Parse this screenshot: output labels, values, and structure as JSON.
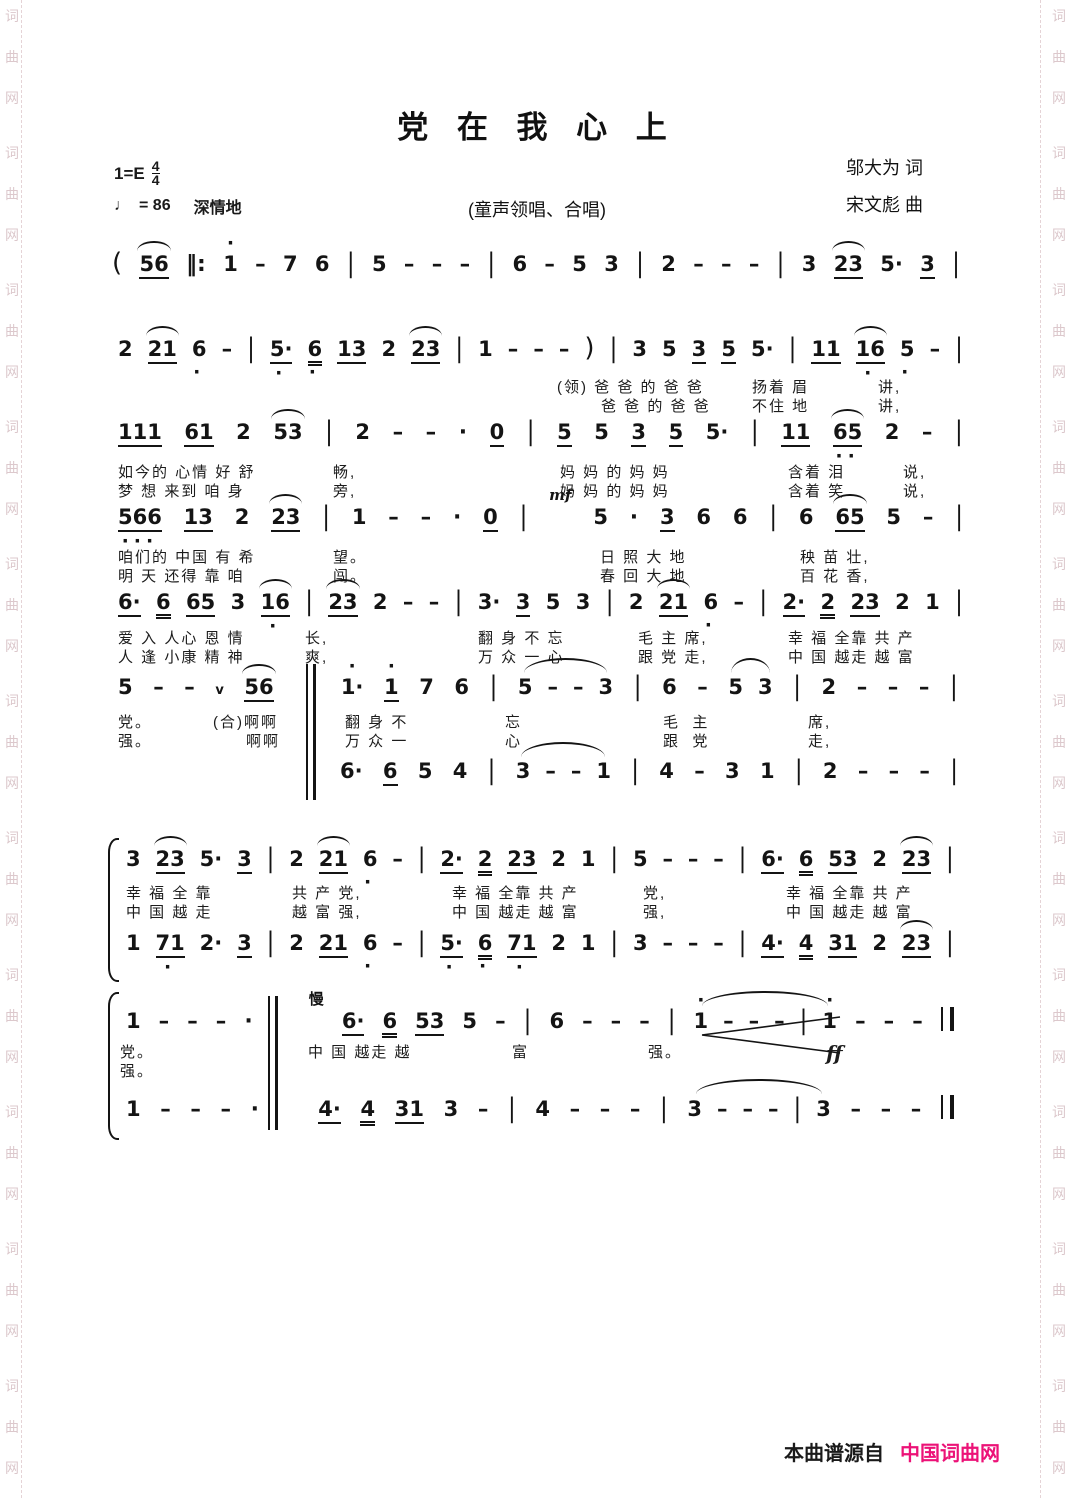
{
  "header": {
    "title": "党  在  我  心  上",
    "subtitle": "(童声领唱、合唱)",
    "lyricist": "邬大为  词",
    "composer": "宋文彪  曲",
    "key": "1=E",
    "meter_num": "4",
    "meter_den": "4",
    "tempo_note_icon": "♩",
    "tempo": "= 86",
    "expression": "深情地"
  },
  "watermark": {
    "chars": [
      "词",
      "曲",
      "网"
    ],
    "repeat": 11,
    "color": "#dcc8cc"
  },
  "footer": {
    "source_label": "本曲谱源自",
    "site_name": "中国词曲网",
    "site_color": "#ec1277"
  },
  "systems": [
    {
      "voices": [
        {
          "x": 112,
          "y": 248,
          "w": 848,
          "tokens": [
            "(",
            "56:u1,sl",
            "||:",
            "1:da",
            "-",
            "7",
            "6",
            "|",
            "5",
            "-",
            "-",
            "-",
            "|",
            "6",
            "-",
            "5",
            "3",
            "|",
            "2",
            "-",
            "-",
            "-",
            "|",
            "3",
            "23:u1,sl",
            "5·",
            "3:u1",
            "|"
          ]
        }
      ],
      "lyrics": []
    },
    {
      "voices": [
        {
          "x": 118,
          "y": 333,
          "w": 845,
          "tokens": [
            "2",
            "21:u1,sl",
            "6:db",
            "-",
            "|",
            "5·:u1,db",
            "6:u2,db",
            "13:u1",
            "2",
            "23:u1,sl",
            "|",
            "1",
            "-",
            "-",
            "-",
            ")",
            "|",
            "3",
            "5",
            "3:u1",
            "5:u1",
            "5·",
            "|",
            "11:u1",
            "16:u1,sl,db",
            "5:db",
            "-",
            "|"
          ]
        }
      ],
      "lyrics": [
        {
          "y": 376,
          "segs": [
            {
              "x": 557,
              "t": "(领) 爸 爸 的 爸 爸"
            },
            {
              "x": 752,
              "t": "扬着 眉"
            },
            {
              "x": 878,
              "t": "讲,"
            }
          ]
        },
        {
          "y": 395,
          "segs": [
            {
              "x": 601,
              "t": "爸 爸 的 爸 爸"
            },
            {
              "x": 752,
              "t": "不住 地"
            },
            {
              "x": 878,
              "t": "讲,"
            }
          ]
        }
      ]
    },
    {
      "voices": [
        {
          "x": 118,
          "y": 419,
          "w": 845,
          "tokens": [
            "111:u1",
            "61:u1",
            "2",
            "53:sl",
            "|",
            "2",
            "-",
            "-",
            "·",
            "0:u1",
            "|",
            "5:u1",
            "5",
            "3:u1",
            "5:u1",
            "5·",
            "|",
            "11:u1",
            "65:u1,sl,db2",
            "2",
            "-",
            "|"
          ]
        }
      ],
      "lyrics": [
        {
          "y": 461,
          "segs": [
            {
              "x": 118,
              "t": "如今的 心情 好 舒"
            },
            {
              "x": 333,
              "t": "畅,"
            },
            {
              "x": 560,
              "t": "妈 妈 的 妈 妈"
            },
            {
              "x": 788,
              "t": "含着 泪"
            },
            {
              "x": 903,
              "t": "说,"
            }
          ]
        },
        {
          "y": 480,
          "segs": [
            {
              "x": 118,
              "t": "梦 想 来到 咱 身"
            },
            {
              "x": 333,
              "t": "旁,"
            },
            {
              "x": 560,
              "t": "妈 妈 的 妈 妈"
            },
            {
              "x": 788,
              "t": "含着 笑"
            },
            {
              "x": 903,
              "t": "说,"
            }
          ]
        }
      ]
    },
    {
      "voices": [
        {
          "x": 118,
          "y": 504,
          "w": 845,
          "tokens": [
            "566:u1,db3",
            "13:u1",
            "2",
            "23:u1,sl",
            "|",
            "1",
            "-",
            "-",
            "·",
            "0:u1",
            "|",
            "mf:dyn,above",
            "5",
            "·",
            "3:u1",
            "6",
            "6",
            "|",
            "6",
            "65:u1,sl",
            "5",
            "-",
            "|"
          ]
        }
      ],
      "lyrics": [
        {
          "y": 546,
          "segs": [
            {
              "x": 118,
              "t": "咱们的 中国 有 希"
            },
            {
              "x": 333,
              "t": "望。"
            },
            {
              "x": 600,
              "t": "日 照 大 地"
            },
            {
              "x": 800,
              "t": "秧 苗 壮,"
            }
          ]
        },
        {
          "y": 565,
          "segs": [
            {
              "x": 118,
              "t": "明 天 还得 靠 咱"
            },
            {
              "x": 333,
              "t": "闯。"
            },
            {
              "x": 600,
              "t": "春 回 大 地"
            },
            {
              "x": 800,
              "t": "百 花 香,"
            }
          ]
        }
      ]
    },
    {
      "voices": [
        {
          "x": 118,
          "y": 589,
          "w": 845,
          "tokens": [
            "6·:u1",
            "6:u2",
            "65:u1",
            "3",
            "16:u1,sl,db",
            "|",
            "23:u1,sl",
            "2",
            "-",
            "-",
            "|",
            "3·",
            "3:u1",
            "5",
            "3",
            "|",
            "2",
            "21:u1,sl",
            "6:db",
            "-",
            "|",
            "2·:u1",
            "2:u2",
            "23:u1",
            "2",
            "1",
            "|"
          ]
        }
      ],
      "lyrics": [
        {
          "y": 627,
          "segs": [
            {
              "x": 118,
              "t": "爱 入 人心 恩 情"
            },
            {
              "x": 305,
              "t": "长,"
            },
            {
              "x": 478,
              "t": "翻 身 不 忘"
            },
            {
              "x": 638,
              "t": "毛 主 席,"
            },
            {
              "x": 788,
              "t": "幸 福 全靠 共 产"
            }
          ]
        },
        {
          "y": 646,
          "segs": [
            {
              "x": 118,
              "t": "人 逢 小康 精 神"
            },
            {
              "x": 305,
              "t": "爽,"
            },
            {
              "x": 478,
              "t": "万 众 一 心"
            },
            {
              "x": 638,
              "t": "跟 党 走,"
            },
            {
              "x": 788,
              "t": "中 国 越走 越 富"
            }
          ]
        }
      ]
    },
    {
      "voices": [
        {
          "x": 118,
          "y": 674,
          "w": 840,
          "tokens": [
            "5",
            "-",
            "-",
            "v:breath",
            "56:u1,sl",
            {
              "sp": 26
            },
            "1·:da",
            "1:u1,da",
            "7",
            "6",
            "|",
            {
              "g": [
                "5",
                "-",
                "-",
                "3"
              ]
            },
            "|",
            "6",
            "-",
            {
              "g": [
                "5",
                "3"
              ]
            },
            "|",
            "2",
            "-",
            "-",
            "-",
            "|"
          ]
        },
        {
          "x": 340,
          "y": 758,
          "w": 618,
          "tokens": [
            "6·",
            "6:u1",
            "5",
            "4",
            "|",
            {
              "g": [
                "3",
                "-",
                "-",
                "1"
              ]
            },
            "|",
            "4",
            "-",
            "3",
            "1",
            "|",
            "2",
            "-",
            "-",
            "-",
            "|"
          ]
        }
      ],
      "lyrics": [
        {
          "y": 711,
          "segs": [
            {
              "x": 118,
              "t": "党。"
            },
            {
              "x": 213,
              "t": "(合)啊啊"
            },
            {
              "x": 345,
              "t": "翻 身 不"
            },
            {
              "x": 505,
              "t": "忘"
            },
            {
              "x": 663,
              "t": "毛  主"
            },
            {
              "x": 808,
              "t": "席,"
            }
          ]
        },
        {
          "y": 730,
          "segs": [
            {
              "x": 118,
              "t": "强。"
            },
            {
              "x": 246,
              "t": "啊啊"
            },
            {
              "x": 345,
              "t": "万 众 一"
            },
            {
              "x": 505,
              "t": "心"
            },
            {
              "x": 663,
              "t": "跟  党"
            },
            {
              "x": 808,
              "t": "走,"
            }
          ]
        }
      ]
    },
    {
      "voices": [
        {
          "x": 126,
          "y": 846,
          "w": 828,
          "tokens": [
            "3",
            "23:u1,sl",
            "5·",
            "3:u1",
            "|",
            "2",
            "21:u1,sl",
            "6:db",
            "-",
            "|",
            "2·:u1",
            "2:u2",
            "23:u1",
            "2",
            "1",
            "|",
            "5",
            "-",
            "-",
            "-",
            "|",
            "6·:u1",
            "6:u2",
            "53:u1",
            "2",
            "23:u1,sl",
            "|"
          ]
        },
        {
          "x": 126,
          "y": 930,
          "w": 828,
          "tokens": [
            "1",
            "71:u1,db",
            "2·",
            "3:u1",
            "|",
            "2",
            "21:u1",
            "6:db",
            "-",
            "|",
            "5·:u1,db",
            "6:u2,db",
            "71:u1,db",
            "2",
            "1",
            "|",
            "3",
            "-",
            "-",
            "-",
            "|",
            "4·:u1",
            "4:u2",
            "31:u1",
            "2",
            "23:u1,sl",
            "|"
          ]
        }
      ],
      "lyrics": [
        {
          "y": 882,
          "segs": [
            {
              "x": 126,
              "t": "幸 福 全 靠"
            },
            {
              "x": 292,
              "t": "共 产 党,"
            },
            {
              "x": 452,
              "t": "幸 福 全靠 共 产"
            },
            {
              "x": 643,
              "t": "党,"
            },
            {
              "x": 786,
              "t": "幸 福 全靠 共 产"
            }
          ]
        },
        {
          "y": 901,
          "segs": [
            {
              "x": 126,
              "t": "中 国 越 走"
            },
            {
              "x": 292,
              "t": "越 富 强,"
            },
            {
              "x": 452,
              "t": "中 国 越走 越 富"
            },
            {
              "x": 643,
              "t": "强,"
            },
            {
              "x": 786,
              "t": "中 国 越走 越 富"
            }
          ]
        }
      ]
    },
    {
      "voices": [
        {
          "x": 126,
          "y": 1004,
          "w": 828,
          "tokens": [
            "1",
            "-",
            "-",
            "-",
            "·",
            {
              "sp": 20
            },
            "慢:above",
            "6·:u1",
            "6:u2",
            "53:u1",
            "5",
            "-",
            "|",
            "6",
            "-",
            "-",
            "-",
            "|",
            {
              "g": [
                "1:da",
                "-",
                "-",
                "-",
                "|",
                "1:da"
              ]
            },
            "-",
            "-",
            "-",
            "||"
          ]
        },
        {
          "x": 126,
          "y": 1092,
          "w": 828,
          "tokens": [
            "1",
            "-",
            "-",
            "-",
            "·",
            {
              "sp": 20
            },
            "4·:u1",
            "4:u2",
            "31:u1",
            "3",
            "-",
            "|",
            "4",
            "-",
            "-",
            "-",
            "|",
            {
              "g": [
                "3",
                "-",
                "-",
                "-",
                "|",
                "3"
              ]
            },
            "-",
            "-",
            "-",
            "||"
          ]
        }
      ],
      "lyrics": [
        {
          "y": 1041,
          "segs": [
            {
              "x": 120,
              "t": "党。"
            },
            {
              "x": 308,
              "t": "中 国 越走 越"
            },
            {
              "x": 512,
              "t": "富"
            },
            {
              "x": 648,
              "t": "强。"
            },
            {
              "x": 826,
              "t": "ff",
              "dyn": true
            }
          ]
        },
        {
          "y": 1060,
          "segs": [
            {
              "x": 120,
              "t": "强。"
            }
          ]
        }
      ]
    }
  ],
  "decorations": [
    {
      "type": "tallbar",
      "x": 306,
      "y": 664,
      "h": 136
    },
    {
      "type": "brace",
      "x": 108,
      "y": 838,
      "h": 140
    },
    {
      "type": "brace",
      "x": 108,
      "y": 992,
      "h": 144
    },
    {
      "type": "tallbar",
      "x": 268,
      "y": 996,
      "h": 134
    },
    {
      "type": "hairpin",
      "x": 700,
      "y": 1014,
      "w": 142,
      "h": 42
    }
  ]
}
